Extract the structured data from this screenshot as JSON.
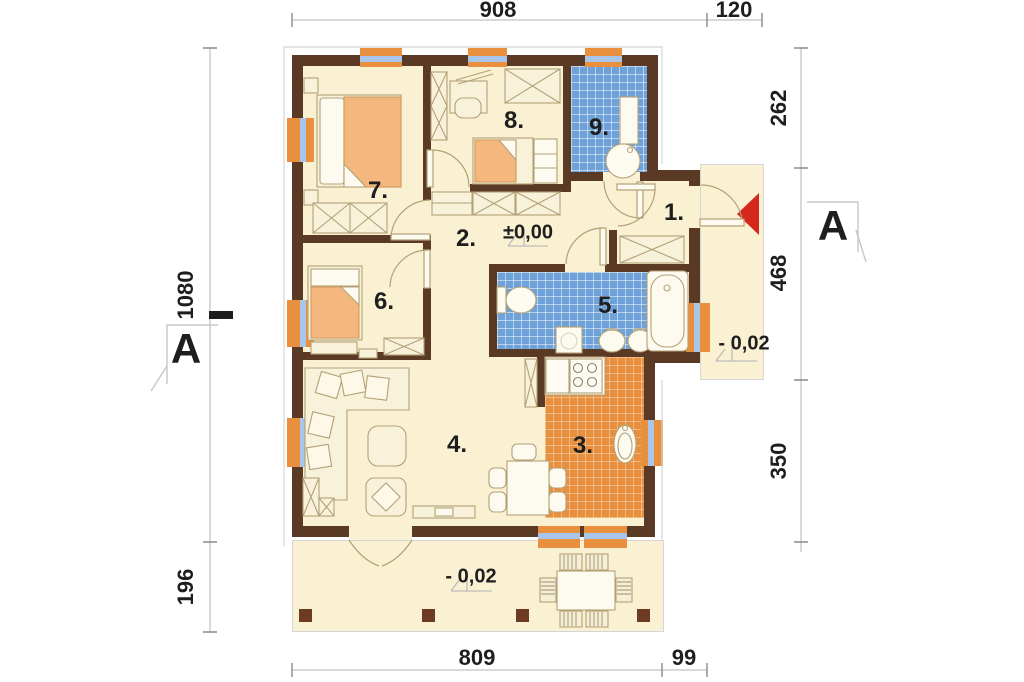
{
  "title": "house-floor-plan",
  "dims": {
    "top_main": "908",
    "top_porch": "120",
    "right_top": "262",
    "right_mid": "468",
    "right_bottom": "350",
    "bottom_main": "809",
    "bottom_right": "99",
    "left_main": "1080",
    "left_terrace": "196"
  },
  "rooms": {
    "r1": "1.",
    "r2": "2.",
    "r3": "3.",
    "r4": "4.",
    "r5": "5.",
    "r6": "6.",
    "r7": "7.",
    "r8": "8.",
    "r9": "9."
  },
  "levels": {
    "hall": "±0,00",
    "porch": "- 0,02",
    "terrace": "- 0,02"
  },
  "sections": {
    "left": "A",
    "right": "A"
  },
  "colors": {
    "wall": "#5b3a25",
    "floor": "#faf1d3",
    "bath_tile": "#6fa2d8",
    "kitchen_tile": "#e8903e",
    "window_frame": "#e8903e",
    "window_glass": "#a8c6e9",
    "entrance_arrow": "#d5271b"
  }
}
